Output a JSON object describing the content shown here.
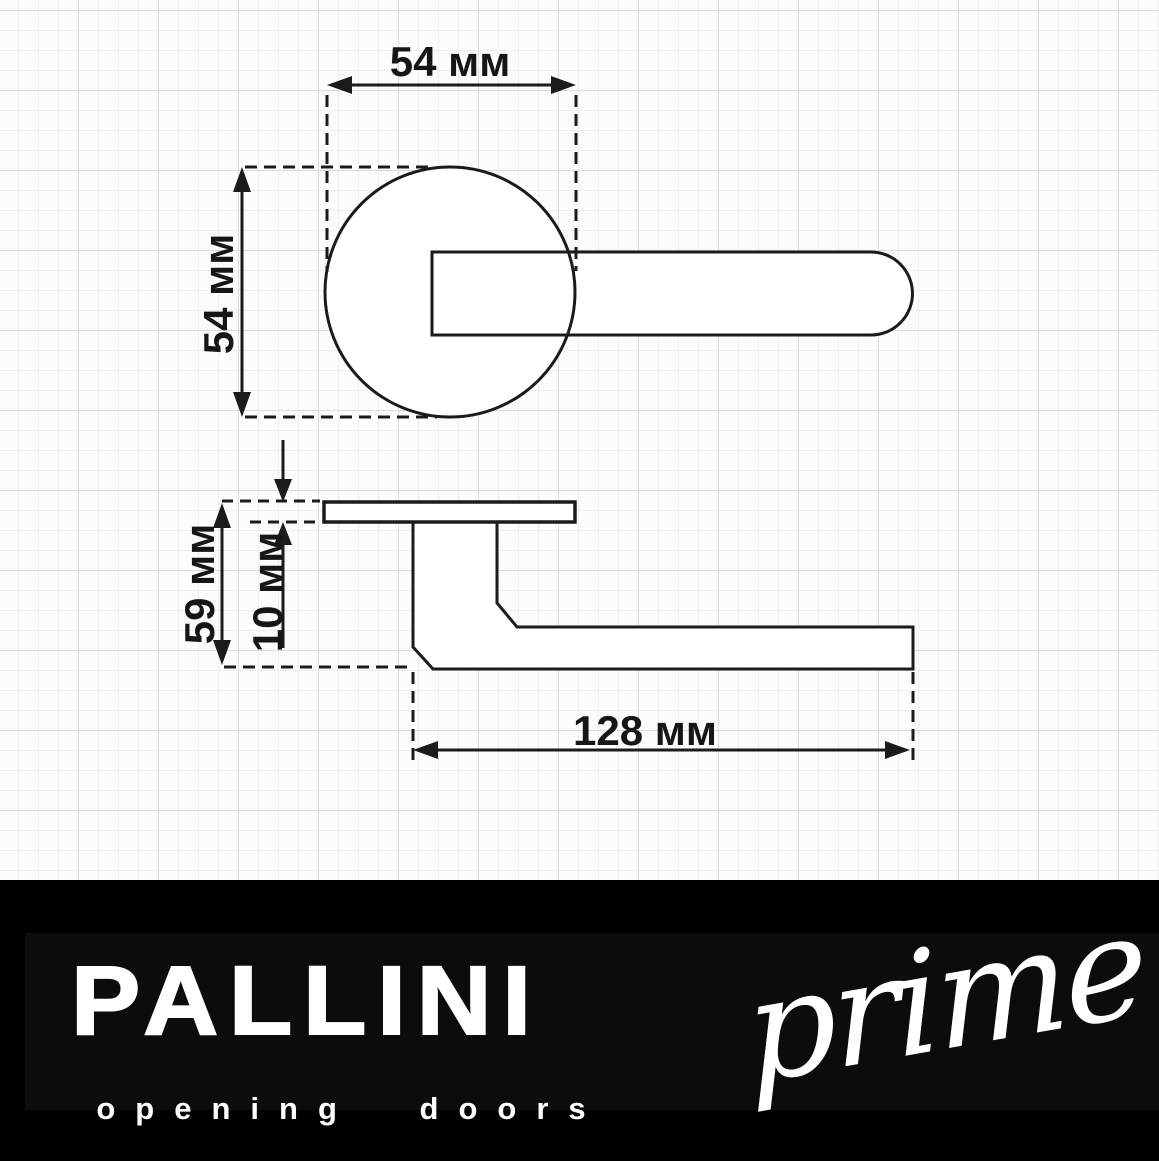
{
  "drawing": {
    "title_hint": "door-handle dimension drawing",
    "dimensions": {
      "rosette_width": "54 мм",
      "rosette_height": "54 мм",
      "side_height": "59 мм",
      "rosette_thickness": "10 мм",
      "handle_length": "128 мм"
    },
    "colors": {
      "line": "#1b1b1b",
      "sheet_background": "#fcfcfc",
      "grid_minor": "#efefef",
      "grid_major": "#dcdcdc",
      "shape_fill": "#ffffff"
    }
  },
  "footer": {
    "brand": "PALLINI",
    "tagline": "opening doors",
    "sub_brand": "prime",
    "background": "#000000",
    "text_color": "#ffffff"
  }
}
